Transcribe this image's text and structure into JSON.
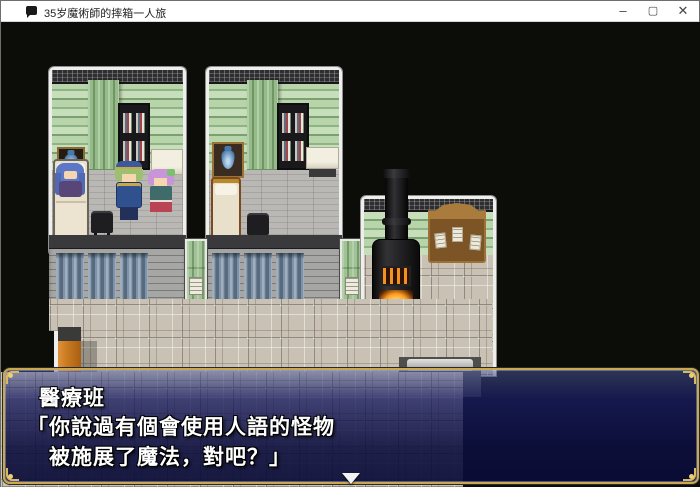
{
  "window": {
    "title": "35岁魔術師的摔箱一人旅",
    "controls": {
      "minimize": "–",
      "maximize": "▢",
      "close": "✕"
    }
  },
  "dialogue": {
    "speaker": "醫療班",
    "line1": "「你說過有個會使用人語的怪物",
    "line2": "　被施展了魔法，對吧？」"
  },
  "scene": {
    "objects": [
      "left-room",
      "right-room",
      "bookshelves",
      "green-curtains",
      "vase-pictures",
      "beds",
      "patients",
      "nurse-character",
      "soldier-character",
      "hall-curtained-wall",
      "green-doors",
      "stove-with-fire",
      "notice-board",
      "panel-floor",
      "entry-steps",
      "orange-pillar"
    ]
  },
  "colors": {
    "dialog_navy": "#12124e",
    "frame_gold": "#c9a850",
    "wallpaper_green": "#aac89e",
    "floor_beige": "#c9c2b4",
    "fire_orange": "#ff9a1e",
    "curtain_blue": "#7e93a9"
  }
}
